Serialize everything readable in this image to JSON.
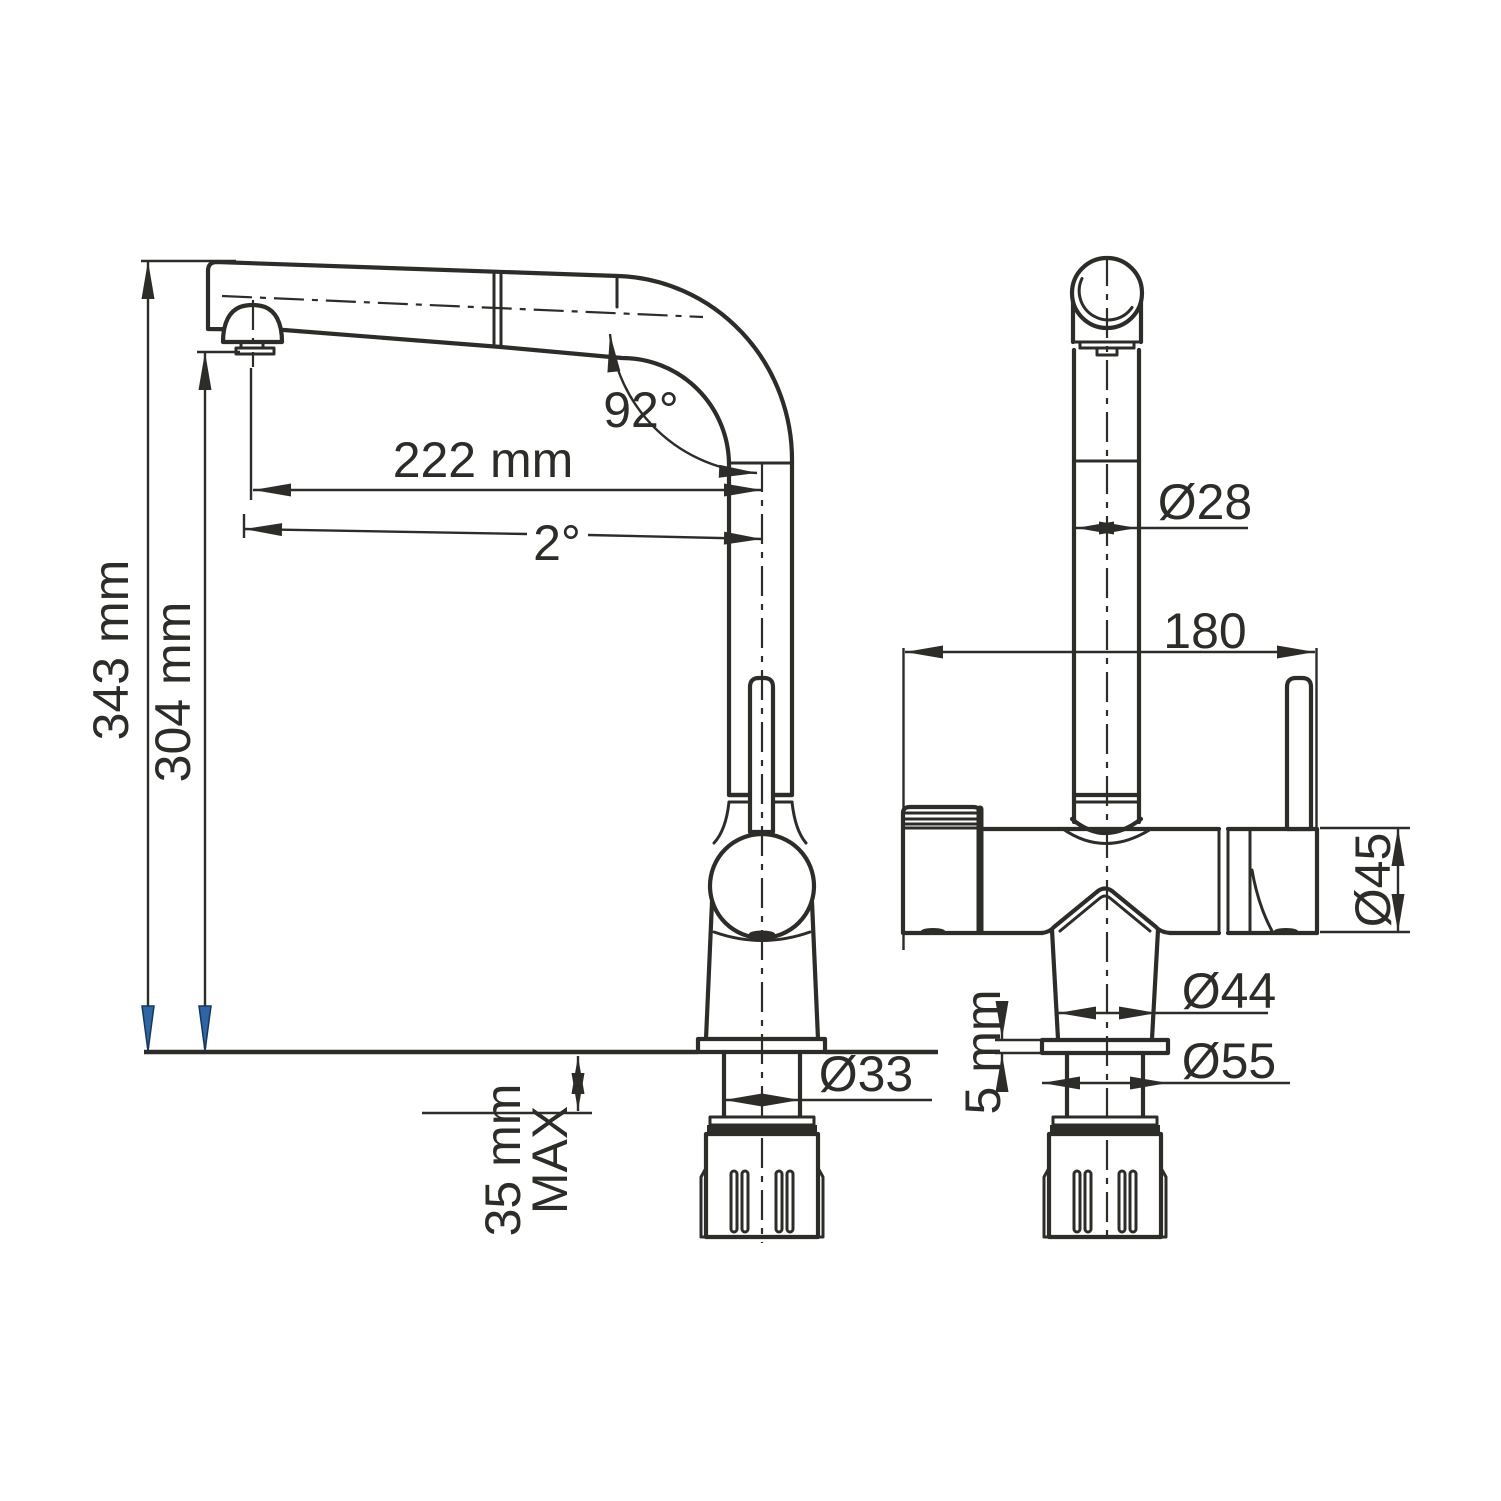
{
  "drawing": {
    "type": "faucet-dimension-drawing",
    "background": "#ffffff",
    "line_color": "#2e2c29",
    "datum_arrow_color": "#2d66a3",
    "views": {
      "side_view": "side view (pull-out spout faucet)",
      "front_view": "front view"
    },
    "dimensions": {
      "total_height": "343 mm",
      "spout_height": "304 mm",
      "spout_reach": "222 mm",
      "spout_tilt": "2°",
      "spout_angle": "92°",
      "column_diameter": "Ø28",
      "body_width": "180",
      "handle_diameter": "Ø45",
      "base_diameter": "Ø44",
      "flange_diameter": "Ø55",
      "flange_height": "5 mm",
      "shank_diameter": "Ø33",
      "deck_max_line1": "35 mm",
      "deck_max_line2": "MAX"
    }
  }
}
